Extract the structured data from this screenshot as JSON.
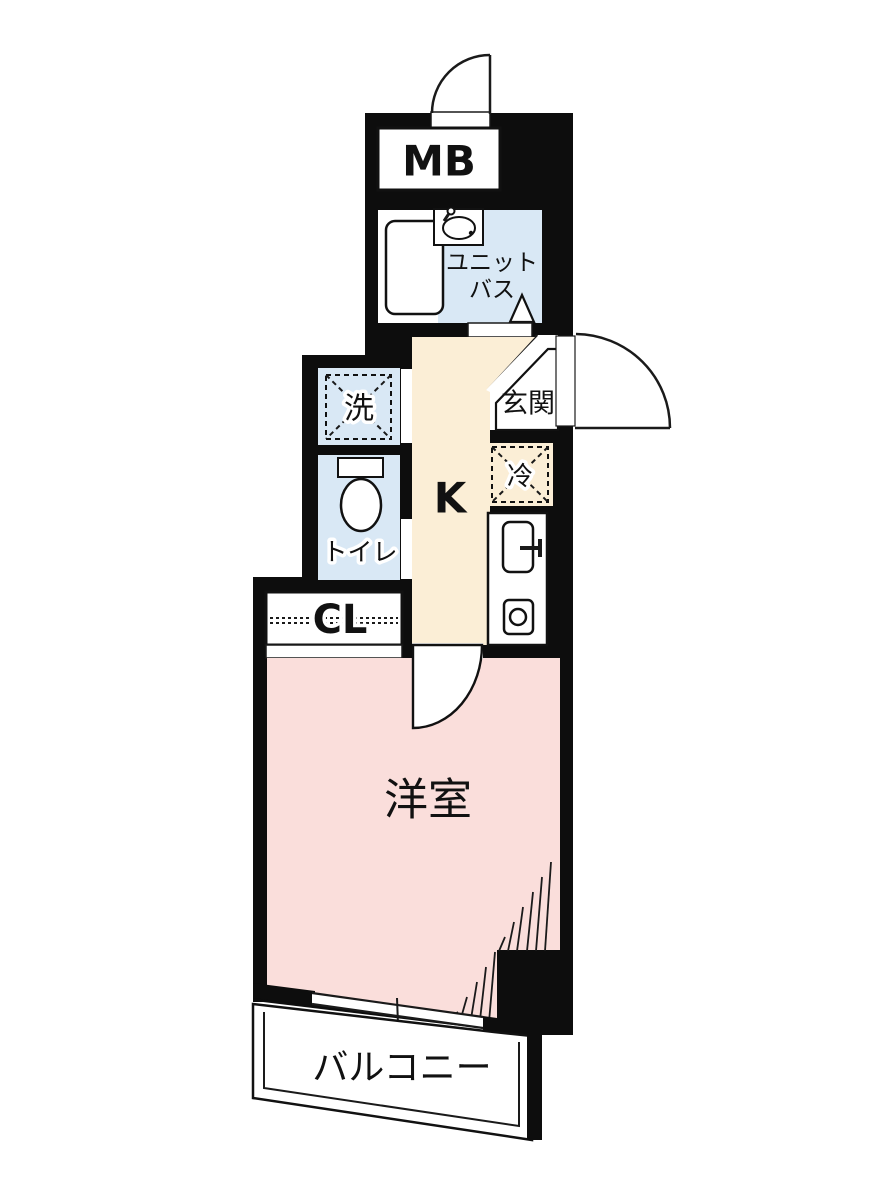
{
  "plan": {
    "rooms": {
      "meter_box": {
        "label": "MB"
      },
      "unit_bath": {
        "label_line1": "ユニット",
        "label_line2": "バス"
      },
      "washer": {
        "label": "洗"
      },
      "toilet": {
        "label": "トイレ"
      },
      "entrance": {
        "label": "玄関"
      },
      "refrigerator": {
        "label": "冷"
      },
      "kitchen": {
        "label": "K"
      },
      "closet": {
        "label": "CL"
      },
      "western_room": {
        "label": "洋室"
      },
      "balcony": {
        "label": "バルコニー"
      }
    },
    "colors": {
      "wall": "#0d0d0d",
      "room_blue": "#d9e8f5",
      "room_cream": "#fbeed6",
      "room_pink": "#fadedb",
      "floor_white": "#ffffff",
      "line": "#1a1a1a"
    }
  }
}
